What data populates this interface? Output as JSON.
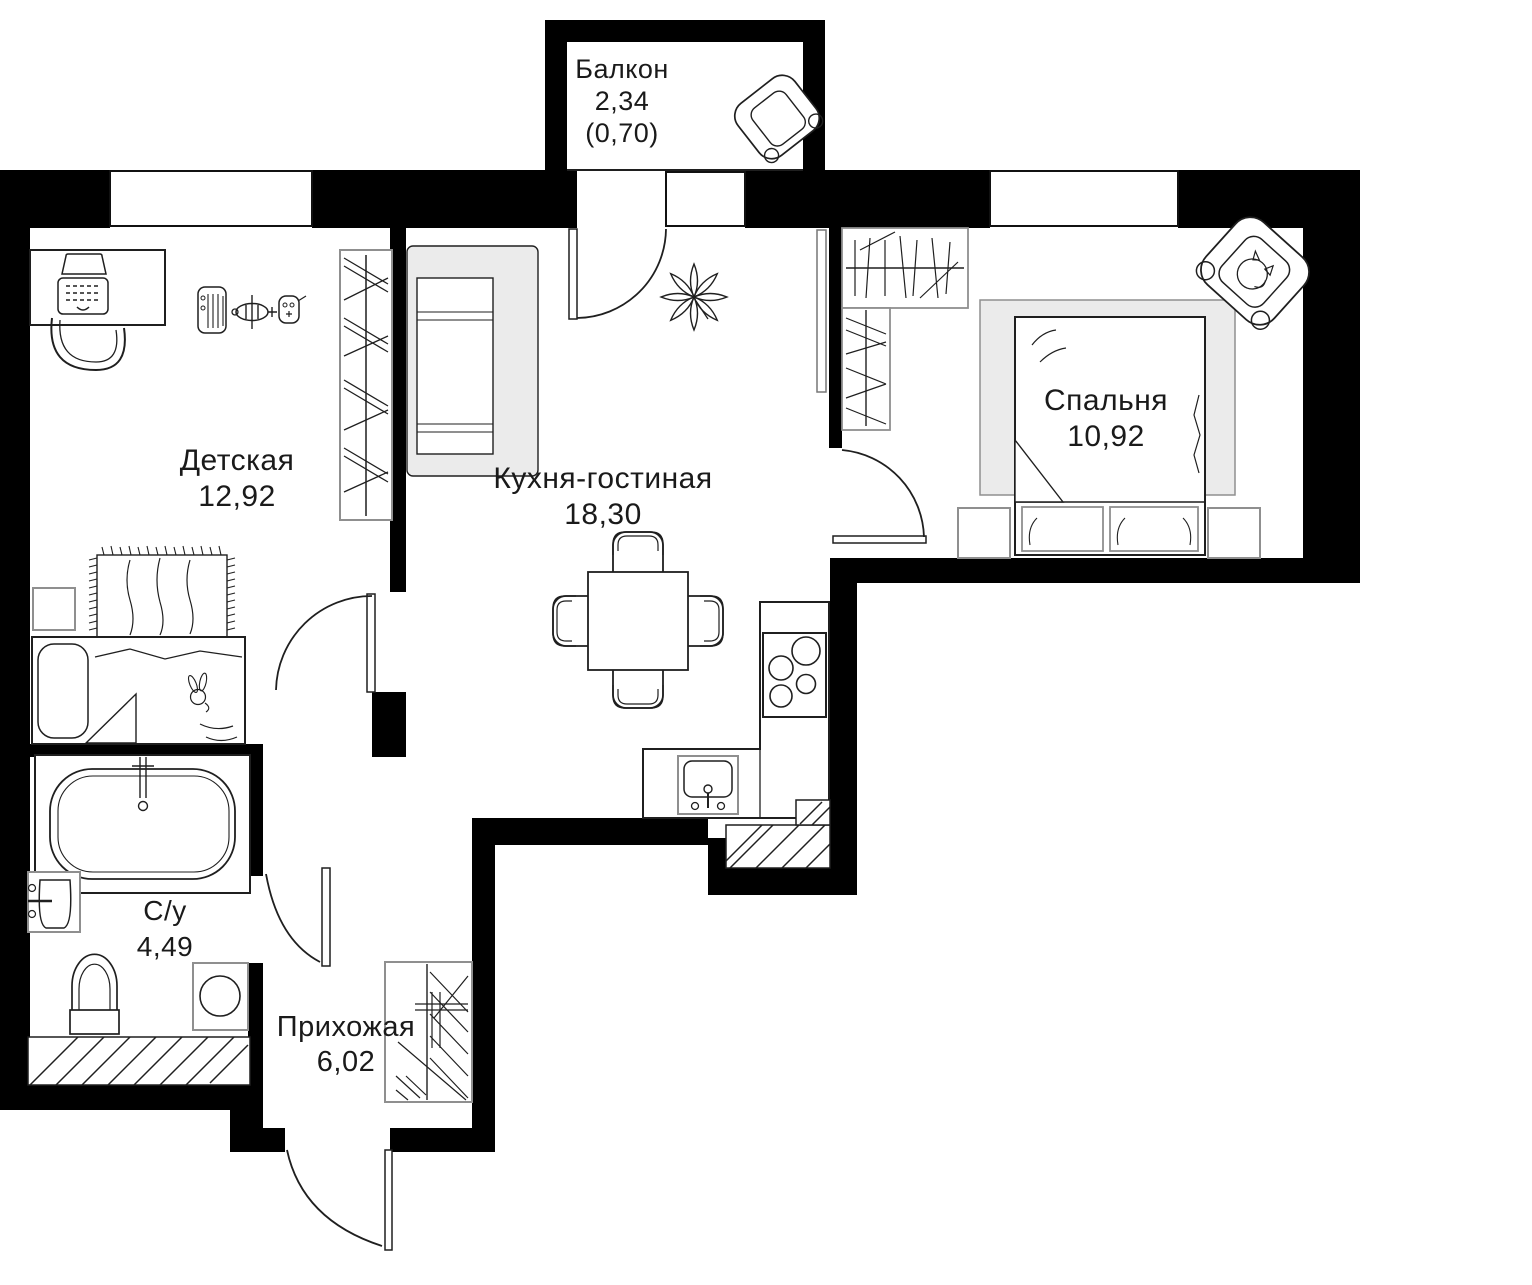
{
  "plan": {
    "type": "apartment-floor-plan",
    "rooms": [
      {
        "name": "Балкон",
        "area": "2,34",
        "area_reduced": "(0,70)"
      },
      {
        "name": "Детская",
        "area": "12,92",
        "area_reduced": ""
      },
      {
        "name": "Кухня-гостиная",
        "area": "18,30",
        "area_reduced": ""
      },
      {
        "name": "Спальня",
        "area": "10,92",
        "area_reduced": ""
      },
      {
        "name": "С/у",
        "area": "4,49",
        "area_reduced": ""
      },
      {
        "name": "Прихожая",
        "area": "6,02",
        "area_reduced": ""
      }
    ],
    "colors": {
      "wall": "#000000",
      "line": "#1f1f1f",
      "muted_stroke": "#8f8f8f",
      "grey_fill": "#ebebeb",
      "background": "#ffffff",
      "text": "#1a1a1a"
    },
    "icons": [
      "desk-icon",
      "laptop-icon",
      "desk-chair-icon",
      "toy-piano-icon",
      "toy-plane-icon",
      "toy-gamepad-icon",
      "wardrobe-hangers-icon",
      "rug-icon",
      "children-bed-icon",
      "bunny-toy-icon",
      "nightstand-icon",
      "sofa-icon",
      "plant-icon",
      "dining-table-icon",
      "dining-chair-icon",
      "kitchen-counter-icon",
      "stove-icon",
      "kitchen-sink-icon",
      "ventilation-shaft-icon",
      "double-bed-icon",
      "bed-rug-icon",
      "armchair-cat-icon",
      "balcony-armchair-icon",
      "bathtub-icon",
      "wash-basin-icon",
      "toilet-icon",
      "washing-machine-icon",
      "hallway-wardrobe-icon",
      "door-swing-icon",
      "window-icon"
    ]
  }
}
